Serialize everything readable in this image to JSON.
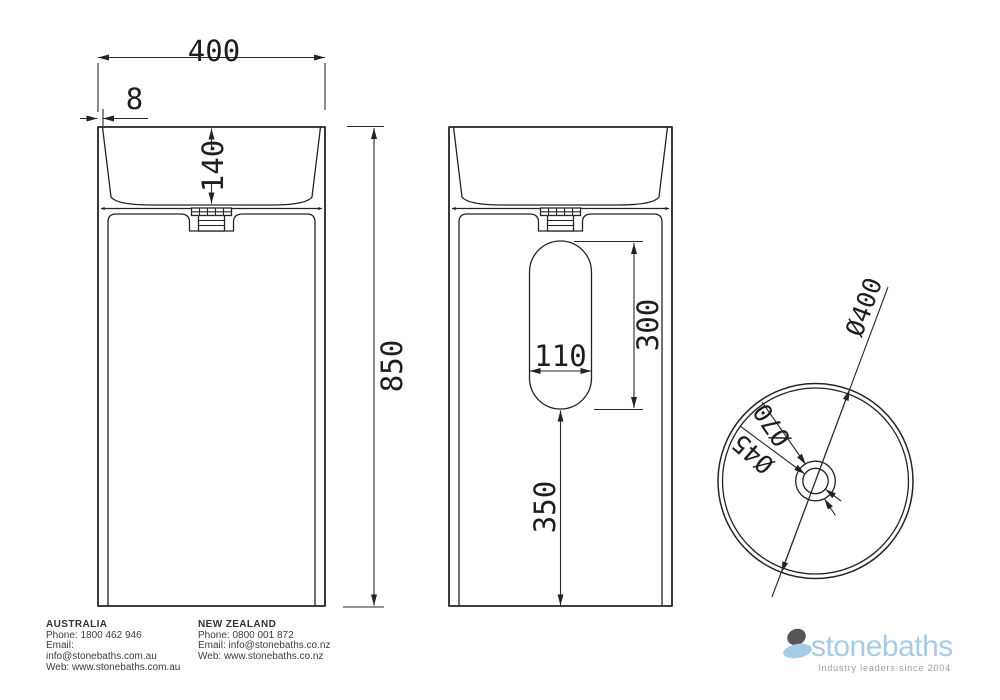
{
  "sheet": {
    "background": "#ffffff",
    "line_color": "#242424"
  },
  "dimensions": {
    "front": {
      "overall_width": "400",
      "rim_thickness": "8",
      "basin_depth": "140",
      "overall_height": "850"
    },
    "back": {
      "slot_width": "110",
      "slot_height": "300",
      "slot_bottom_offset": "350"
    },
    "plan": {
      "outer_diameter": "Ø400",
      "drain_outer_diameter": "Ø70",
      "drain_hole_diameter": "Ø45"
    }
  },
  "footer": {
    "australia": {
      "title": "AUSTRALIA",
      "phone": "Phone: 1800 462 946",
      "email_label": "Email:",
      "email": "info@stonebaths.com.au",
      "web": "Web: www.stonebaths.com.au"
    },
    "new_zealand": {
      "title": "NEW ZEALAND",
      "phone": "Phone: 0800 001 872",
      "email": "Email: info@stonebaths.co.nz",
      "web": "Web: www.stonebaths.co.nz"
    }
  },
  "logo": {
    "name": "stonebaths",
    "tagline": "Industry leaders since 2004",
    "brand_blue": "#a6cbe6",
    "brand_dark": "#55575a"
  }
}
